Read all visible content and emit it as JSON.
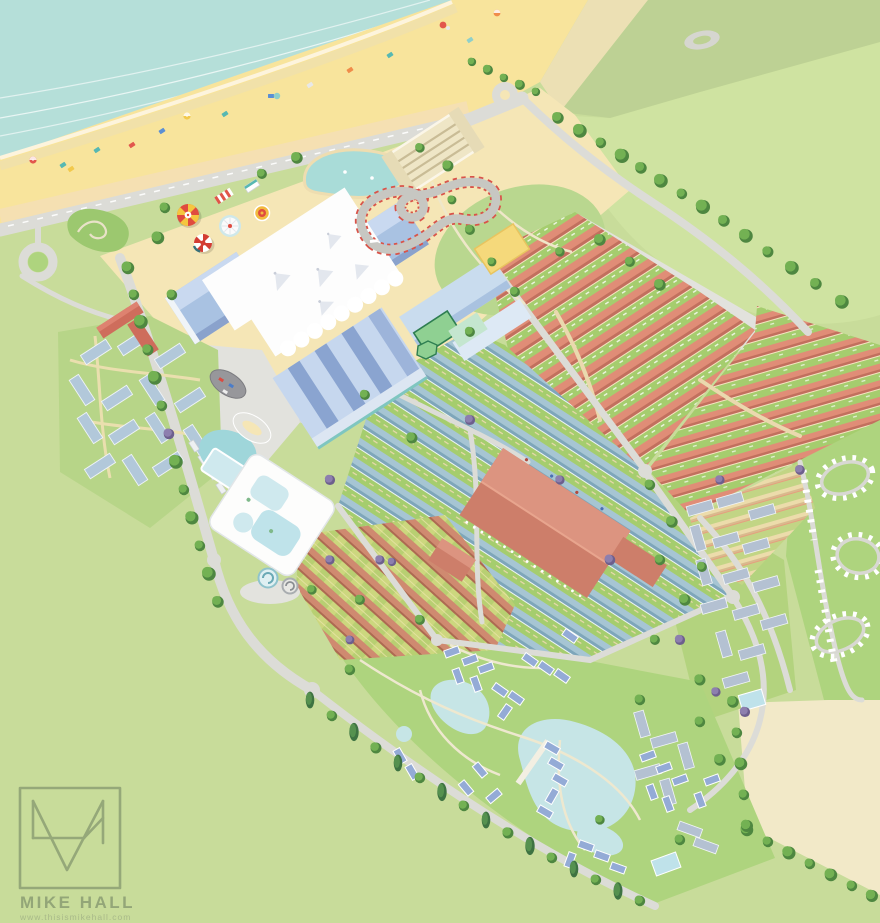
{
  "credit": {
    "name": "MIKE HALL",
    "url": "www.thisismikehall.com",
    "monogram": "MH"
  },
  "palette": {
    "sea": "#b5dfd9",
    "beach": "#f8e49c",
    "dune": "#ece0b4",
    "coast_green": "#bdd194",
    "field_green": "#cfe3a1",
    "base_green": "#c8dc9a",
    "bright_green": "#aed47e",
    "road_grey": "#dcdcd7",
    "plaza_grey": "#e2e2dd",
    "resort_sand": "#f5e6b6",
    "tent_white": "#fdfdfd",
    "pavilion_blue": "#a9c2e2",
    "pavilion_blue_dark": "#8aa2cc",
    "dining_hall_red": "#cd7e6a",
    "chalet_roof_red": "#e08d77",
    "chalet_roof_blue": "#a6c5d3",
    "chalet_roof_tan": "#ecdcab",
    "lake_blue": "#c6e5e6",
    "pool_blue": "#bfe3ea",
    "hotel_cream": "#efe6c6",
    "farm_field_cream": "#f2e9c8",
    "tree_green": "#73b153",
    "conifer_green": "#3e7342",
    "logo_green": "#95a879"
  },
  "features": [
    "sea",
    "beach",
    "promenade",
    "roundabout",
    "mini-golf",
    "funfair",
    "go-kart-track",
    "carousel",
    "helter-skelter",
    "skyline-pavilion",
    "hotel",
    "boating-lake",
    "sports-courts",
    "red-roof-chalet-rows",
    "east-chalet-rows",
    "tan-chalet-rows",
    "garden-chalet-rows",
    "blue-roof-chalet-rows",
    "dining-hall",
    "swimming-pool-complex",
    "west-chalet-quarter",
    "apartment-quarter",
    "caravan-park",
    "lakeside-lodge-village",
    "playing-field",
    "farm-field",
    "artist-logo"
  ]
}
